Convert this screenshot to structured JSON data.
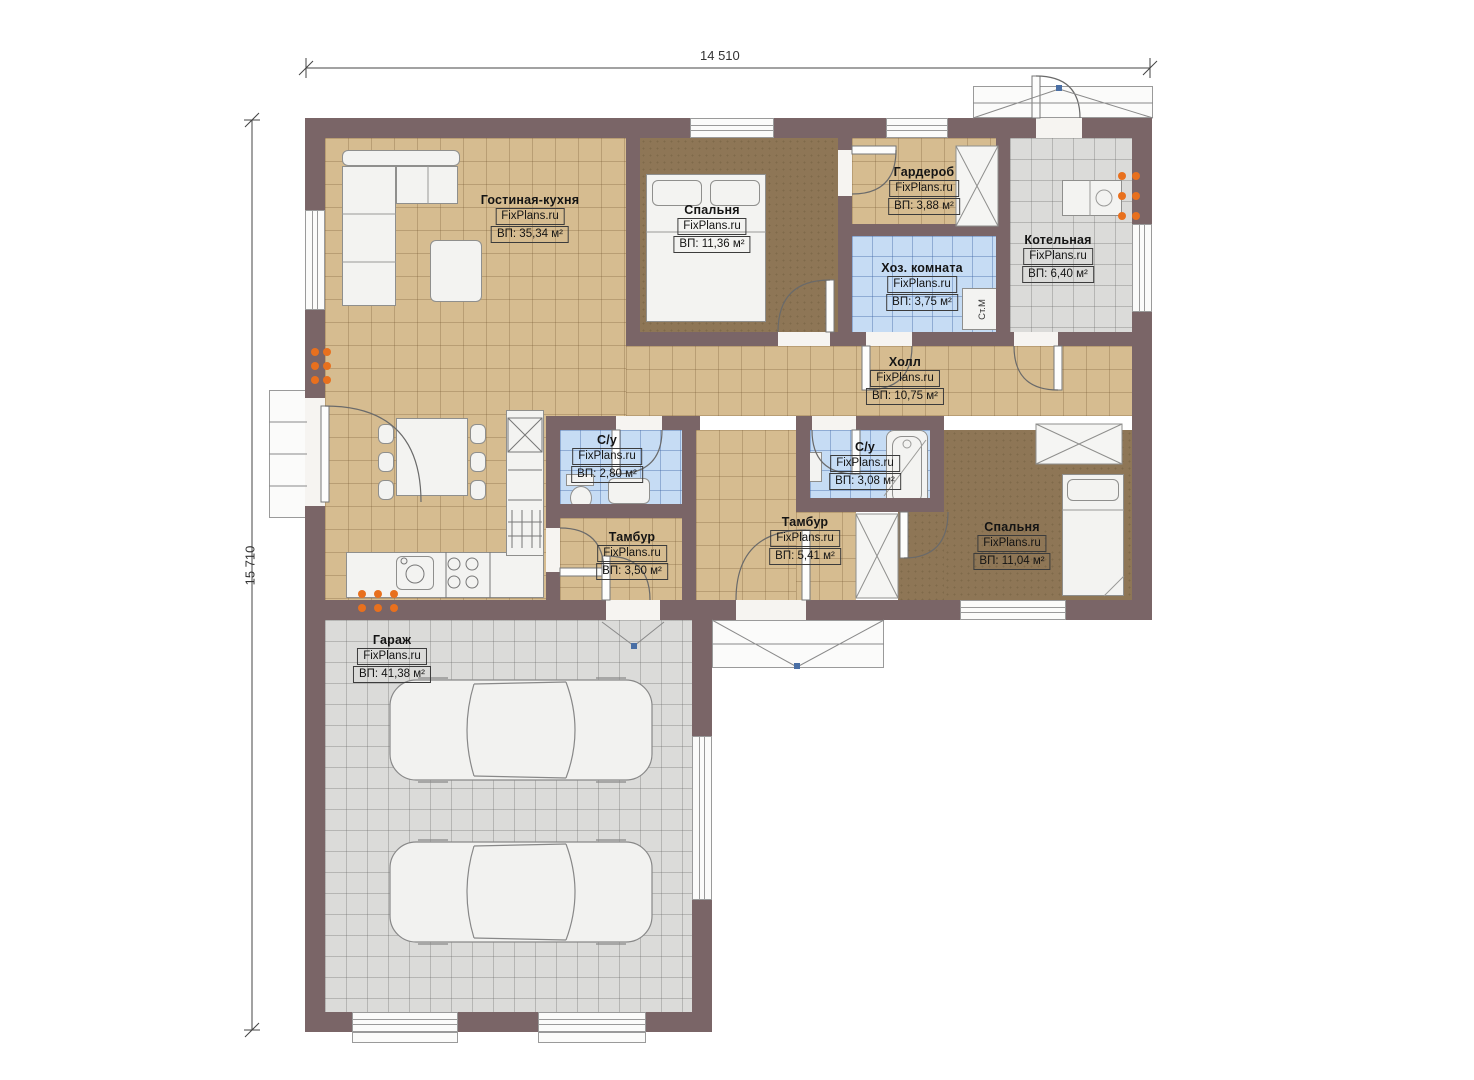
{
  "plan": {
    "dimensions": {
      "width_label": "14 510",
      "height_label": "15 710"
    },
    "rooms": [
      {
        "id": "living",
        "name": "Гостиная-кухня",
        "site": "FixPlans.ru",
        "area": "ВП: 35,34 м²"
      },
      {
        "id": "bedroom1",
        "name": "Спальня",
        "site": "FixPlans.ru",
        "area": "ВП: 11,36 м²"
      },
      {
        "id": "wardrobe",
        "name": "Гардероб",
        "site": "FixPlans.ru",
        "area": "ВП: 3,88 м²"
      },
      {
        "id": "utility",
        "name": "Хоз. комната",
        "site": "FixPlans.ru",
        "area": "ВП: 3,75 м²"
      },
      {
        "id": "boiler",
        "name": "Котельная",
        "site": "FixPlans.ru",
        "area": "ВП: 6,40 м²"
      },
      {
        "id": "hall",
        "name": "Холл",
        "site": "FixPlans.ru",
        "area": "ВП: 10,75 м²"
      },
      {
        "id": "wc1",
        "name": "С/у",
        "site": "FixPlans.ru",
        "area": "ВП: 2,80 м²"
      },
      {
        "id": "wc2",
        "name": "С/у",
        "site": "FixPlans.ru",
        "area": "ВП: 3,08 м²"
      },
      {
        "id": "tambour1",
        "name": "Тамбур",
        "site": "FixPlans.ru",
        "area": "ВП: 3,50 м²"
      },
      {
        "id": "tambour2",
        "name": "Тамбур",
        "site": "FixPlans.ru",
        "area": "ВП: 5,41 м²"
      },
      {
        "id": "bedroom2",
        "name": "Спальня",
        "site": "FixPlans.ru",
        "area": "ВП: 11,04 м²"
      },
      {
        "id": "garage",
        "name": "Гараж",
        "site": "FixPlans.ru",
        "area": "ВП: 41,38 м²"
      }
    ],
    "annotations": {
      "washing_machine": "Ст.М"
    },
    "colors": {
      "wall": "#7a6567",
      "floor_tile_tan": "#d6bc90",
      "floor_carpet": "#8e7656",
      "floor_tile_blue": "#c6dcf4",
      "floor_tile_gray": "#dbdbd9",
      "radiator": "#e8701e",
      "door_marker": "#4a6fa5"
    }
  }
}
